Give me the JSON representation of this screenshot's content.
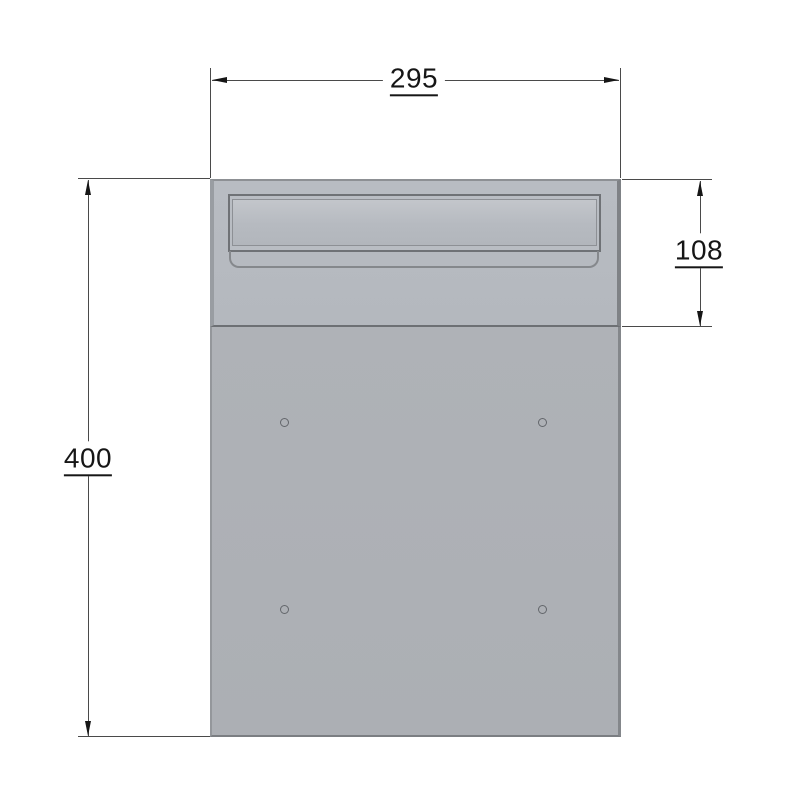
{
  "drawing": {
    "type": "technical-drawing-front-view",
    "subject": "letterbox front panel with letter slot and four screw holes",
    "dimensions": {
      "width": {
        "value": "295",
        "orientation": "horizontal",
        "position": "top"
      },
      "upper_section_height": {
        "value": "108",
        "orientation": "vertical",
        "position": "right"
      },
      "total_height": {
        "value": "400",
        "orientation": "vertical",
        "position": "left"
      }
    },
    "features": {
      "screw_hole_count": 4,
      "letter_slot": "recessed letter slot with flap in upper section"
    },
    "colors": {
      "background": "#ffffff",
      "panel_upper_fill": "#b6bac0",
      "panel_lower_fill": "#adb0b5",
      "slot_fill": "#b9bdc3",
      "edge_shadow": "#7f8286",
      "edge_highlight": "#999da2",
      "outline": "#6d7074",
      "dimension_line": "#4a4a4a",
      "dimension_text": "#161616"
    }
  }
}
